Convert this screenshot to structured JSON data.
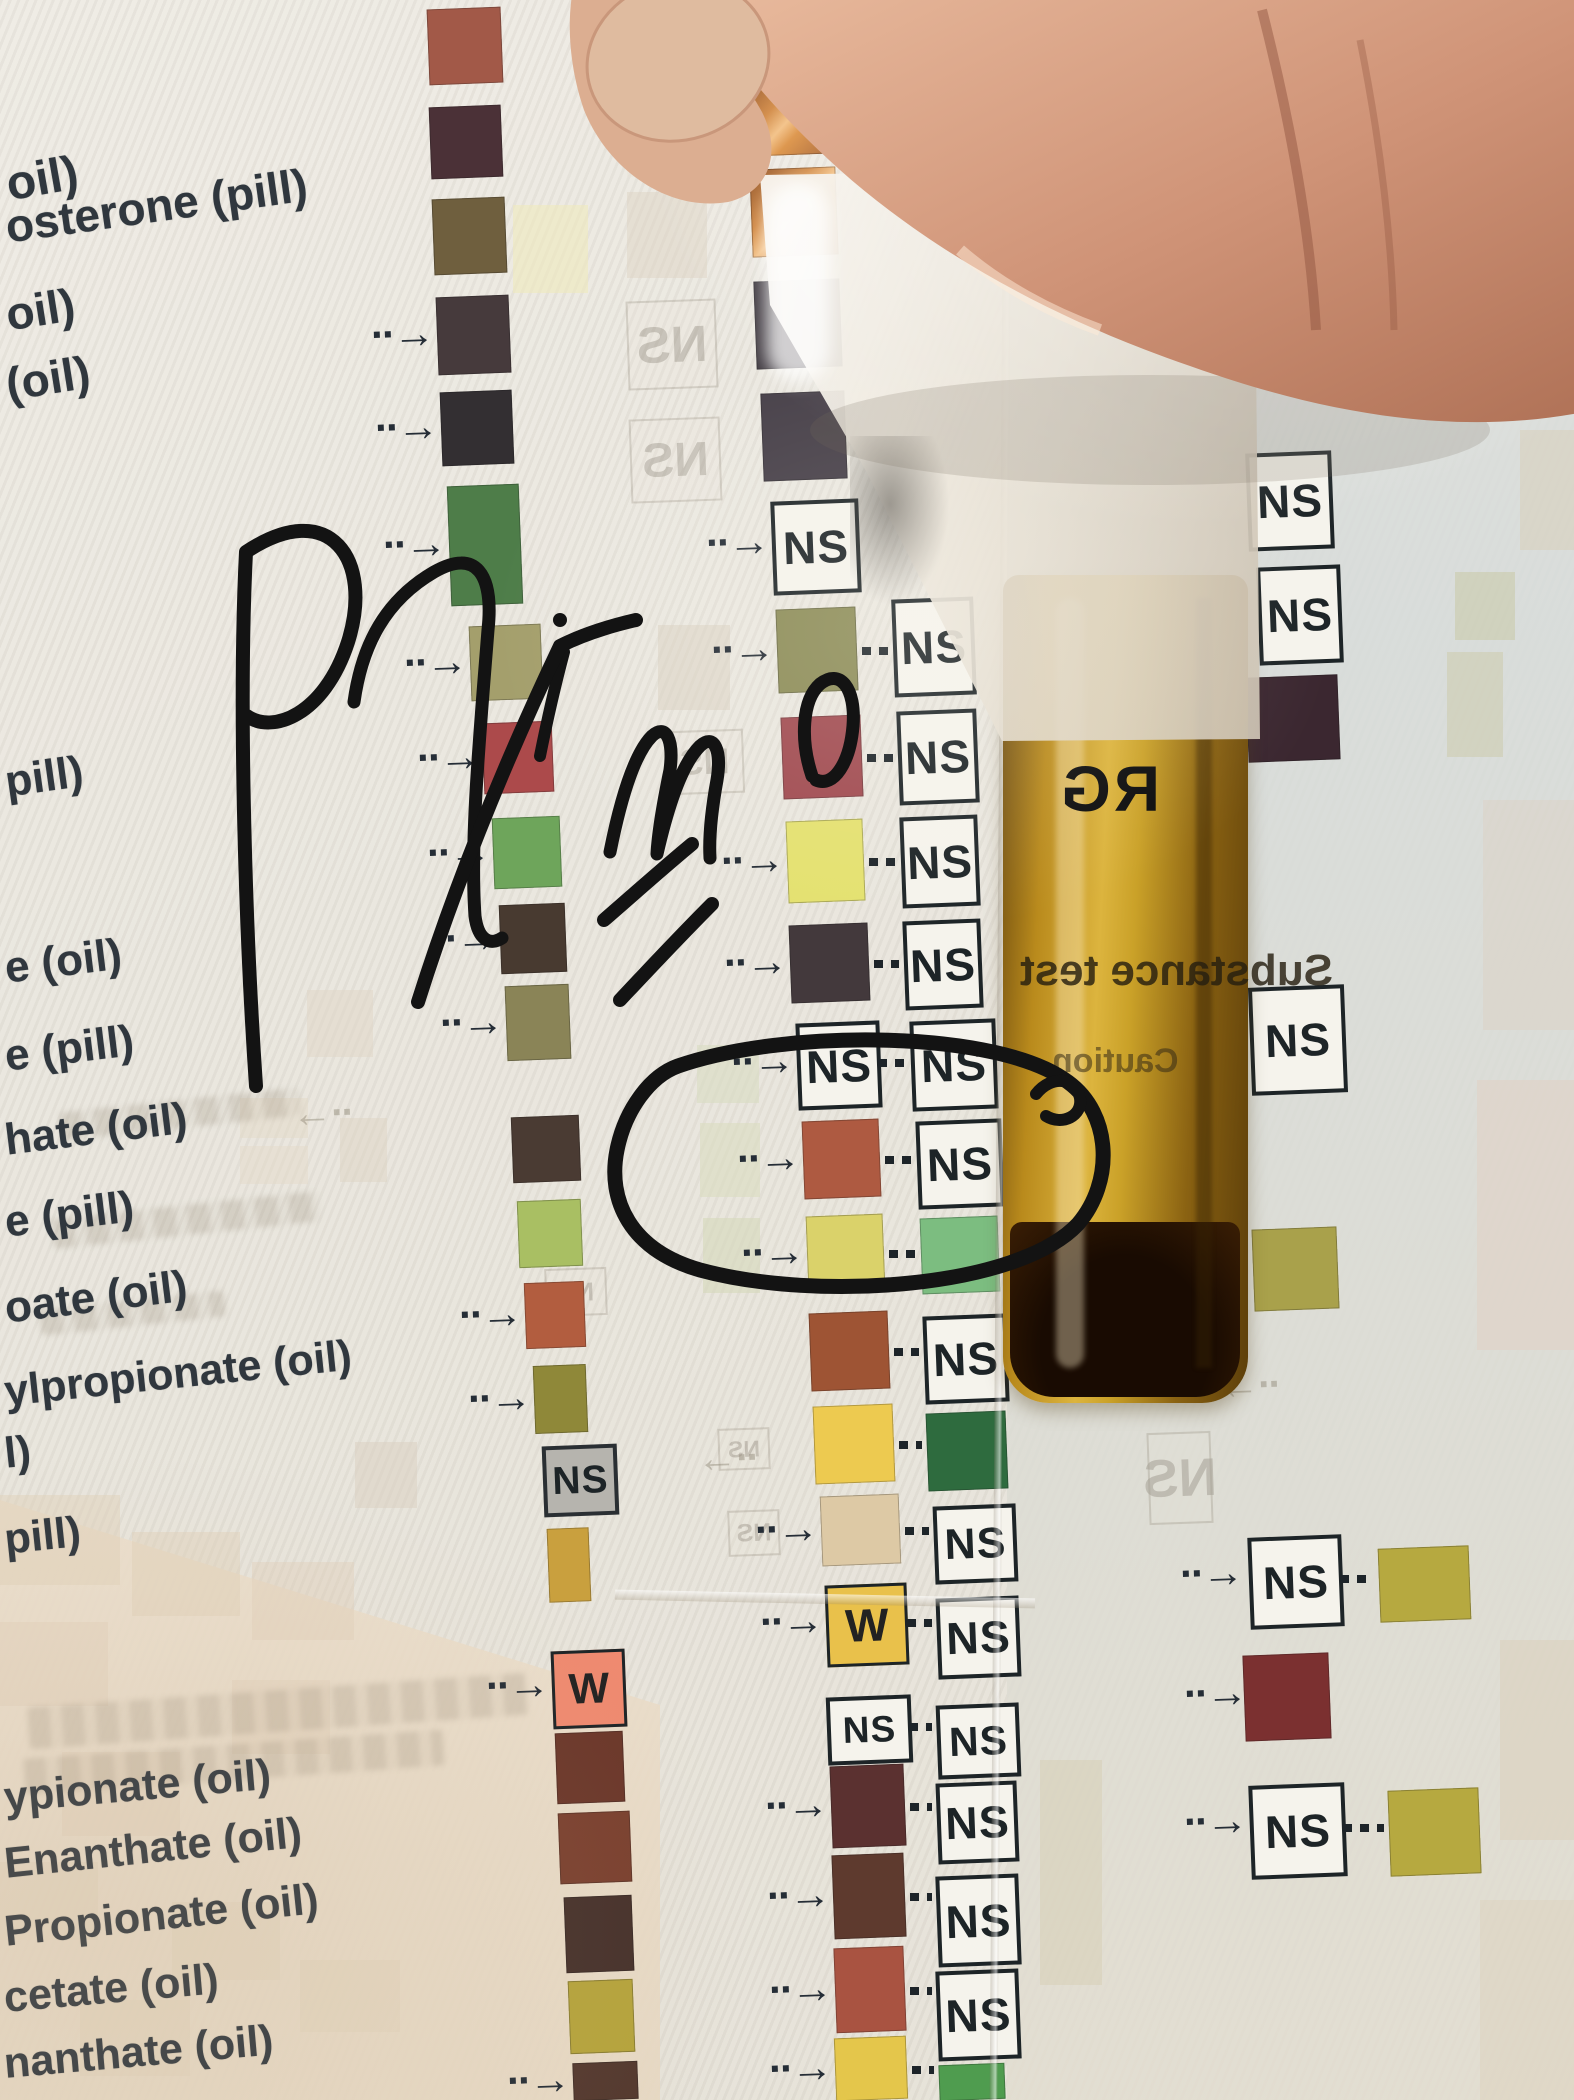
{
  "meta": {
    "ns_label": "NS",
    "w_label": "W"
  },
  "icons": {
    "arrow_right_glyph": "··→",
    "arrow_left_glyph": "··→"
  },
  "annotation": {
    "word": "Primo",
    "letter": "E",
    "circle_note": "hand-drawn marker circle around rust swatch row"
  },
  "vial": {
    "brand": "RG",
    "label_line1": "Substance test",
    "label_line2": "Caution"
  },
  "left_labels": [
    {
      "text": "oil)",
      "x": 2,
      "y": 158,
      "fs": 48,
      "rot": -10
    },
    {
      "text": "osterone (pill)",
      "x": 2,
      "y": 200,
      "fs": 46,
      "rot": -8
    },
    {
      "text": "oil)",
      "x": 2,
      "y": 288,
      "fs": 46,
      "rot": -9
    },
    {
      "text": "(oil)",
      "x": 2,
      "y": 358,
      "fs": 46,
      "rot": -9
    },
    {
      "text": "pill)",
      "x": 2,
      "y": 758,
      "fs": 44,
      "rot": -8
    },
    {
      "text": "e (oil)",
      "x": 2,
      "y": 944,
      "fs": 44,
      "rot": -7
    },
    {
      "text": "e (pill)",
      "x": 2,
      "y": 1032,
      "fs": 44,
      "rot": -7
    },
    {
      "text": "hate (oil)",
      "x": 2,
      "y": 1116,
      "fs": 44,
      "rot": -7
    },
    {
      "text": "e (pill)",
      "x": 2,
      "y": 1198,
      "fs": 44,
      "rot": -7
    },
    {
      "text": "oate (oil)",
      "x": 2,
      "y": 1284,
      "fs": 44,
      "rot": -7
    },
    {
      "text": "ylpropionate (oil)",
      "x": 2,
      "y": 1368,
      "fs": 43,
      "rot": -6
    },
    {
      "text": "l)",
      "x": 2,
      "y": 1430,
      "fs": 43,
      "rot": -6
    },
    {
      "text": "pill)",
      "x": 2,
      "y": 1516,
      "fs": 43,
      "rot": -6
    },
    {
      "text": "ypionate (oil)",
      "x": 2,
      "y": 1774,
      "fs": 43,
      "rot": -5
    },
    {
      "text": "Enanthate (oil)",
      "x": 2,
      "y": 1840,
      "fs": 43,
      "rot": -6
    },
    {
      "text": "Propionate (oil)",
      "x": 2,
      "y": 1908,
      "fs": 43,
      "rot": -6
    },
    {
      "text": "cetate (oil)",
      "x": 2,
      "y": 1974,
      "fs": 43,
      "rot": -5
    },
    {
      "text": "nanthate (oil)",
      "x": 2,
      "y": 2040,
      "fs": 43,
      "rot": -5
    }
  ],
  "column_a": [
    {
      "k": "s",
      "x": 428,
      "y": 8,
      "w": 74,
      "h": 76,
      "c": "#a25948"
    },
    {
      "k": "s",
      "x": 430,
      "y": 106,
      "w": 72,
      "h": 72,
      "c": "#4b3137"
    },
    {
      "k": "s",
      "x": 433,
      "y": 198,
      "w": 73,
      "h": 76,
      "c": "#6f5f3e"
    },
    {
      "k": "s",
      "x": 437,
      "y": 296,
      "w": 73,
      "h": 78,
      "c": "#463a3c",
      "a": 1
    },
    {
      "k": "s",
      "x": 441,
      "y": 391,
      "w": 72,
      "h": 74,
      "c": "#332f32",
      "a": 1
    },
    {
      "k": "s",
      "x": 449,
      "y": 485,
      "w": 72,
      "h": 120,
      "c": "#4e7d49",
      "a": 1
    },
    {
      "k": "s",
      "x": 470,
      "y": 625,
      "w": 72,
      "h": 75,
      "c": "#a49f6c",
      "a": 1
    },
    {
      "k": "s",
      "x": 483,
      "y": 722,
      "w": 70,
      "h": 71,
      "c": "#ac4a4b",
      "a": 1
    },
    {
      "k": "s",
      "x": 493,
      "y": 817,
      "w": 68,
      "h": 71,
      "c": "#6ea55b",
      "a": 1
    },
    {
      "k": "s",
      "x": 500,
      "y": 904,
      "w": 66,
      "h": 69,
      "c": "#483a30",
      "a": 1
    },
    {
      "k": "s",
      "x": 506,
      "y": 985,
      "w": 64,
      "h": 75,
      "c": "#8a8457",
      "a": 1
    },
    {
      "k": "s",
      "x": 512,
      "y": 1116,
      "w": 68,
      "h": 66,
      "c": "#4a3b33"
    },
    {
      "k": "s",
      "x": 518,
      "y": 1200,
      "w": 64,
      "h": 67,
      "c": "#a9bf63"
    },
    {
      "k": "s",
      "x": 525,
      "y": 1282,
      "w": 60,
      "h": 66,
      "c": "#b25d3f",
      "a": 1
    },
    {
      "k": "s",
      "x": 534,
      "y": 1365,
      "w": 53,
      "h": 68,
      "c": "#8f8839",
      "a": 1
    },
    {
      "k": "n",
      "x": 543,
      "y": 1445,
      "w": 67,
      "h": 63,
      "gray": 1
    },
    {
      "k": "s",
      "x": 548,
      "y": 1528,
      "w": 42,
      "h": 74,
      "c": "#c9a03e"
    },
    {
      "k": "w",
      "x": 552,
      "y": 1650,
      "w": 68,
      "h": 72,
      "c": "#ef8a70",
      "a": 1
    },
    {
      "k": "s",
      "x": 556,
      "y": 1732,
      "w": 68,
      "h": 71,
      "c": "#6b372a"
    },
    {
      "k": "s",
      "x": 559,
      "y": 1812,
      "w": 72,
      "h": 71,
      "c": "#7a402f"
    },
    {
      "k": "s",
      "x": 565,
      "y": 1896,
      "w": 68,
      "h": 76,
      "c": "#46312b"
    },
    {
      "k": "s",
      "x": 569,
      "y": 1980,
      "w": 65,
      "h": 73,
      "c": "#b5a43c"
    },
    {
      "k": "s",
      "x": 573,
      "y": 2062,
      "w": 65,
      "h": 38,
      "c": "#53382e",
      "a": 1
    }
  ],
  "column_b": [
    {
      "k": "c",
      "x": 748,
      "y": 75,
      "w": 84,
      "h": 80
    },
    {
      "k": "c",
      "x": 751,
      "y": 168,
      "w": 86,
      "h": 88
    },
    {
      "k": "s",
      "x": 755,
      "y": 280,
      "w": 86,
      "h": 88,
      "c": "#413b42"
    },
    {
      "k": "s",
      "x": 762,
      "y": 392,
      "w": 84,
      "h": 88,
      "c": "#474049"
    },
    {
      "k": "n",
      "x": 772,
      "y": 500,
      "w": 80,
      "h": 86,
      "a": 1
    },
    {
      "k": "s",
      "x": 777,
      "y": 608,
      "w": 80,
      "h": 84,
      "c": "#8b8b56",
      "a": 1,
      "l": {
        "k": "n",
        "x": 893,
        "y": 598,
        "w": 74,
        "h": 90
      }
    },
    {
      "k": "s",
      "x": 782,
      "y": 716,
      "w": 80,
      "h": 82,
      "c": "#a04a50",
      "l": {
        "k": "n",
        "x": 898,
        "y": 710,
        "w": 72,
        "h": 86
      }
    },
    {
      "k": "s",
      "x": 787,
      "y": 820,
      "w": 77,
      "h": 82,
      "c": "#e4e170",
      "a": 1,
      "l": {
        "k": "n",
        "x": 901,
        "y": 816,
        "w": 70,
        "h": 83
      }
    },
    {
      "k": "s",
      "x": 790,
      "y": 924,
      "w": 79,
      "h": 78,
      "c": "#43393c",
      "a": 1,
      "l": {
        "k": "n",
        "x": 904,
        "y": 920,
        "w": 70,
        "h": 81
      }
    },
    {
      "k": "n",
      "x": 797,
      "y": 1022,
      "w": 76,
      "h": 79,
      "a": 1,
      "l": {
        "k": "n",
        "x": 911,
        "y": 1020,
        "w": 78,
        "h": 82
      }
    },
    {
      "k": "s",
      "x": 803,
      "y": 1120,
      "w": 77,
      "h": 78,
      "c": "#ae5a41",
      "a": 1,
      "l": {
        "k": "n",
        "x": 917,
        "y": 1120,
        "w": 78,
        "h": 80
      }
    },
    {
      "k": "s",
      "x": 807,
      "y": 1215,
      "w": 77,
      "h": 76,
      "c": "#dad26a",
      "a": 1,
      "l": {
        "k": "s",
        "x": 921,
        "y": 1217,
        "w": 78,
        "h": 76,
        "c": "#7cbd80"
      }
    },
    {
      "k": "s",
      "x": 810,
      "y": 1312,
      "w": 79,
      "h": 78,
      "c": "#9e5434",
      "l": {
        "k": "n",
        "x": 924,
        "y": 1315,
        "w": 76,
        "h": 80
      }
    },
    {
      "k": "s",
      "x": 814,
      "y": 1405,
      "w": 80,
      "h": 78,
      "c": "#edca50",
      "l": {
        "k": "s",
        "x": 927,
        "y": 1412,
        "w": 80,
        "h": 78,
        "c": "#2e6b3e"
      }
    },
    {
      "k": "s",
      "x": 821,
      "y": 1495,
      "w": 79,
      "h": 70,
      "c": "#ddc9a5",
      "a": 1,
      "l": {
        "k": "n",
        "x": 934,
        "y": 1505,
        "w": 75,
        "h": 70
      }
    },
    {
      "k": "w",
      "x": 826,
      "y": 1584,
      "w": 76,
      "h": 76,
      "c": "#e9c14b",
      "a": 1,
      "l": {
        "k": "n",
        "x": 937,
        "y": 1597,
        "w": 75,
        "h": 73
      }
    },
    {
      "k": "n",
      "x": 827,
      "y": 1696,
      "w": 77,
      "h": 60,
      "l": {
        "k": "n",
        "x": 937,
        "y": 1704,
        "w": 75,
        "h": 66
      }
    },
    {
      "k": "s",
      "x": 831,
      "y": 1765,
      "w": 74,
      "h": 82,
      "c": "#5b3130",
      "a": 1,
      "l": {
        "k": "n",
        "x": 937,
        "y": 1782,
        "w": 73,
        "h": 73
      }
    },
    {
      "k": "s",
      "x": 833,
      "y": 1854,
      "w": 72,
      "h": 84,
      "c": "#5e3a2e",
      "a": 1,
      "l": {
        "k": "n",
        "x": 937,
        "y": 1875,
        "w": 75,
        "h": 83
      }
    },
    {
      "k": "s",
      "x": 835,
      "y": 1947,
      "w": 70,
      "h": 85,
      "c": "#a95341",
      "a": 1,
      "l": {
        "k": "n",
        "x": 937,
        "y": 1970,
        "w": 75,
        "h": 82
      }
    },
    {
      "k": "s",
      "x": 835,
      "y": 2037,
      "w": 72,
      "h": 63,
      "c": "#e4c64b",
      "a": 1,
      "l": {
        "k": "s",
        "x": 939,
        "y": 2064,
        "w": 66,
        "h": 36,
        "c": "#4f9c4f"
      }
    }
  ],
  "column_c": [
    {
      "k": "n",
      "x": 1247,
      "y": 452,
      "w": 78,
      "h": 90
    },
    {
      "k": "n",
      "x": 1258,
      "y": 566,
      "w": 76,
      "h": 90
    },
    {
      "k": "s",
      "x": 1247,
      "y": 676,
      "w": 92,
      "h": 85,
      "c": "#3b2730"
    },
    {
      "k": "n",
      "x": 1250,
      "y": 986,
      "w": 88,
      "h": 100
    },
    {
      "k": "s",
      "x": 1253,
      "y": 1228,
      "w": 85,
      "h": 82,
      "c": "#a9a14b",
      "ax": 1177,
      "ay": 1240
    },
    {
      "k": "n",
      "x": 1249,
      "y": 1536,
      "w": 86,
      "h": 84,
      "ax": 1180,
      "ay": 1552,
      "l": {
        "k": "s",
        "x": 1379,
        "y": 1547,
        "w": 91,
        "h": 74,
        "c": "#b6a940"
      }
    },
    {
      "k": "s",
      "x": 1244,
      "y": 1654,
      "w": 86,
      "h": 86,
      "c": "#7b3030",
      "ax": 1184,
      "ay": 1672
    },
    {
      "k": "n",
      "x": 1250,
      "y": 1784,
      "w": 88,
      "h": 86,
      "ax": 1184,
      "ay": 1800,
      "l": {
        "k": "s",
        "x": 1389,
        "y": 1789,
        "w": 91,
        "h": 86,
        "c": "#b6a940"
      }
    }
  ],
  "ghosts": [
    {
      "k": "q",
      "x": 623,
      "y": 0,
      "w": 84,
      "h": 73,
      "c": "#ddd3c4",
      "op": 0.55
    },
    {
      "k": "q",
      "x": 627,
      "y": 90,
      "w": 66,
      "h": 87,
      "c": "#e9e4d8",
      "op": 0.5
    },
    {
      "k": "q",
      "x": 513,
      "y": 205,
      "w": 75,
      "h": 88,
      "c": "#eeeabc",
      "op": 0.6
    },
    {
      "k": "q",
      "x": 627,
      "y": 192,
      "w": 80,
      "h": 86,
      "c": "#ded4c4",
      "op": 0.5
    },
    {
      "k": "q",
      "x": 658,
      "y": 625,
      "w": 72,
      "h": 85,
      "c": "#d8cdbd",
      "op": 0.5
    },
    {
      "k": "q",
      "x": 307,
      "y": 990,
      "w": 66,
      "h": 67,
      "c": "#e0d6c6",
      "op": 0.5
    },
    {
      "k": "q",
      "x": 340,
      "y": 1118,
      "w": 47,
      "h": 64,
      "c": "#ddd3c3",
      "op": 0.5
    },
    {
      "k": "q",
      "x": 355,
      "y": 1442,
      "w": 62,
      "h": 66,
      "c": "#d9cfbf",
      "op": 0.5
    },
    {
      "k": "q",
      "x": 697,
      "y": 1045,
      "w": 62,
      "h": 58,
      "c": "#d9dcc2",
      "op": 0.6
    },
    {
      "k": "q",
      "x": 700,
      "y": 1123,
      "w": 60,
      "h": 74,
      "c": "#dadcc0",
      "op": 0.6
    },
    {
      "k": "q",
      "x": 703,
      "y": 1218,
      "w": 57,
      "h": 75,
      "c": "#d5d8ba",
      "op": 0.6
    },
    {
      "k": "q",
      "x": 240,
      "y": 1098,
      "w": 68,
      "h": 40,
      "c": "#e4d9c8",
      "op": 0.5
    },
    {
      "k": "q",
      "x": 240,
      "y": 1146,
      "w": 68,
      "h": 38,
      "c": "#e4d9c8",
      "op": 0.45
    },
    {
      "k": "q",
      "x": 1477,
      "y": 36,
      "w": 97,
      "h": 160,
      "c": "#d3c9ae",
      "op": 0.5
    },
    {
      "k": "q",
      "x": 1483,
      "y": 228,
      "w": 91,
      "h": 110,
      "c": "#b9aeb2",
      "op": 0.45
    },
    {
      "k": "q",
      "x": 1520,
      "y": 430,
      "w": 54,
      "h": 120,
      "c": "#d8cdb4",
      "op": 0.45
    },
    {
      "k": "q",
      "x": 1455,
      "y": 572,
      "w": 60,
      "h": 68,
      "c": "#c8c8a6",
      "op": 0.55
    },
    {
      "k": "q",
      "x": 1447,
      "y": 652,
      "w": 56,
      "h": 105,
      "c": "#cccaa8",
      "op": 0.5
    },
    {
      "k": "q",
      "x": 1483,
      "y": 800,
      "w": 91,
      "h": 230,
      "c": "#dbcfc0",
      "op": 0.4
    },
    {
      "k": "q",
      "x": 1477,
      "y": 1080,
      "w": 97,
      "h": 270,
      "c": "#e3cfc0",
      "op": 0.45
    },
    {
      "k": "q",
      "x": 1040,
      "y": 1760,
      "w": 62,
      "h": 225,
      "c": "#d5ceb3",
      "op": 0.5
    },
    {
      "k": "q",
      "x": 1500,
      "y": 1640,
      "w": 74,
      "h": 200,
      "c": "#d9ccb4",
      "op": 0.4
    },
    {
      "k": "q",
      "x": 1480,
      "y": 1900,
      "w": 94,
      "h": 200,
      "c": "#ddd0ba",
      "op": 0.4
    },
    {
      "k": "q",
      "x": 0,
      "y": 1495,
      "w": 120,
      "h": 90,
      "c": "#e0d0b8",
      "op": 0.45
    },
    {
      "k": "q",
      "x": 132,
      "y": 1532,
      "w": 108,
      "h": 84,
      "c": "#e0d0b8",
      "op": 0.45
    },
    {
      "k": "q",
      "x": 252,
      "y": 1562,
      "w": 102,
      "h": 78,
      "c": "#e0d0b8",
      "op": 0.4
    },
    {
      "k": "q",
      "x": 0,
      "y": 1622,
      "w": 108,
      "h": 84,
      "c": "#e0d0b8",
      "op": 0.4
    },
    {
      "k": "q",
      "x": 232,
      "y": 1680,
      "w": 98,
      "h": 74,
      "c": "#e0d0b8",
      "op": 0.4
    },
    {
      "k": "q",
      "x": 62,
      "y": 1752,
      "w": 118,
      "h": 84,
      "c": "#e0d0b8",
      "op": 0.4
    },
    {
      "k": "q",
      "x": 0,
      "y": 1862,
      "w": 98,
      "h": 78,
      "c": "#e0d0b8",
      "op": 0.35
    },
    {
      "k": "q",
      "x": 172,
      "y": 1902,
      "w": 108,
      "h": 78,
      "c": "#e0d0b8",
      "op": 0.35
    },
    {
      "k": "q",
      "x": 300,
      "y": 1960,
      "w": 100,
      "h": 72,
      "c": "#e0d0b8",
      "op": 0.35
    },
    {
      "k": "q",
      "x": 80,
      "y": 2000,
      "w": 110,
      "h": 76,
      "c": "#e0d0b8",
      "op": 0.35
    },
    {
      "k": "gns",
      "x": 627,
      "y": 300,
      "w": 86,
      "h": 85
    },
    {
      "k": "gns",
      "x": 630,
      "y": 418,
      "w": 87,
      "h": 80
    },
    {
      "k": "gns",
      "x": 665,
      "y": 730,
      "w": 75,
      "h": 60
    },
    {
      "k": "gns",
      "x": 718,
      "y": 1428,
      "w": 48,
      "h": 38
    },
    {
      "k": "gns",
      "x": 728,
      "y": 1510,
      "w": 48,
      "h": 42
    },
    {
      "k": "gns",
      "x": 545,
      "y": 1268,
      "w": 58,
      "h": 44
    },
    {
      "k": "gns",
      "x": 1082,
      "y": 1140,
      "w": 58,
      "h": 46
    },
    {
      "k": "gns",
      "x": 1086,
      "y": 1318,
      "w": 56,
      "h": 40
    },
    {
      "k": "gns",
      "x": 1148,
      "y": 1432,
      "w": 60,
      "h": 88
    },
    {
      "k": "garr",
      "x": 295,
      "y": 1093
    },
    {
      "k": "garr",
      "x": 1222,
      "y": 1365
    },
    {
      "k": "garr",
      "x": 700,
      "y": 1438
    },
    {
      "k": "m",
      "x": 60,
      "y": 1100,
      "w": 240,
      "h": 28,
      "rot": -6
    },
    {
      "k": "m",
      "x": 52,
      "y": 1205,
      "w": 268,
      "h": 30,
      "rot": -6
    },
    {
      "k": "m",
      "x": 40,
      "y": 1300,
      "w": 185,
      "h": 26,
      "rot": -6
    },
    {
      "k": "m",
      "x": 28,
      "y": 1690,
      "w": 500,
      "h": 42,
      "rot": -4
    },
    {
      "k": "m",
      "x": 24,
      "y": 1744,
      "w": 420,
      "h": 36,
      "rot": -4
    }
  ]
}
